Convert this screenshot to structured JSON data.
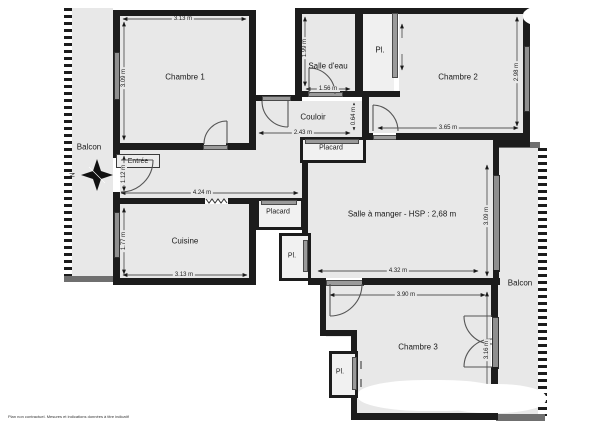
{
  "plan": {
    "rooms": {
      "chambre1": {
        "name": "Chambre 1",
        "width": "3.13 m",
        "height": "3.09 m"
      },
      "salle_deau": {
        "name": "Salle d'eau",
        "width": "1.56 m",
        "height": "1.99 m"
      },
      "placard_haut": {
        "name": "Pl."
      },
      "chambre2": {
        "name": "Chambre 2",
        "width": "3.65 m",
        "height": "2.98 m"
      },
      "couloir": {
        "name": "Couloir",
        "width": "2.43 m",
        "height": "0.64 m"
      },
      "placard_couloir": {
        "name": "Placard"
      },
      "entree": {
        "name": "Entrée",
        "height": "1.12 m",
        "hall_width": "4.24 m"
      },
      "cuisine": {
        "name": "Cuisine",
        "width": "3.13 m",
        "height": "1.77 m"
      },
      "placard_cuisine": {
        "name": "Placard"
      },
      "pl_salle_a_manger": {
        "name": "Pl."
      },
      "salle_a_manger": {
        "name": "Salle à manger - HSP : 2,68 m",
        "width": "4.32 m",
        "height": "3.09 m"
      },
      "chambre3": {
        "name": "Chambre 3",
        "width": "3.90 m",
        "height": "3.16 m"
      },
      "pl_chambre3": {
        "name": "Pl."
      },
      "balcon_gauche": {
        "name": "Balcon"
      },
      "balcon_droit": {
        "name": "Balcon"
      }
    },
    "compass": {
      "north": "N"
    },
    "footer": {
      "disclaimer": "Plan non contractuel. Mesures et indications données à titre indicatif"
    },
    "colors": {
      "wall": "#1c1c1c",
      "room_fill": "#e8e8e8",
      "window": "#8f8f8f",
      "background": "#ffffff"
    }
  }
}
